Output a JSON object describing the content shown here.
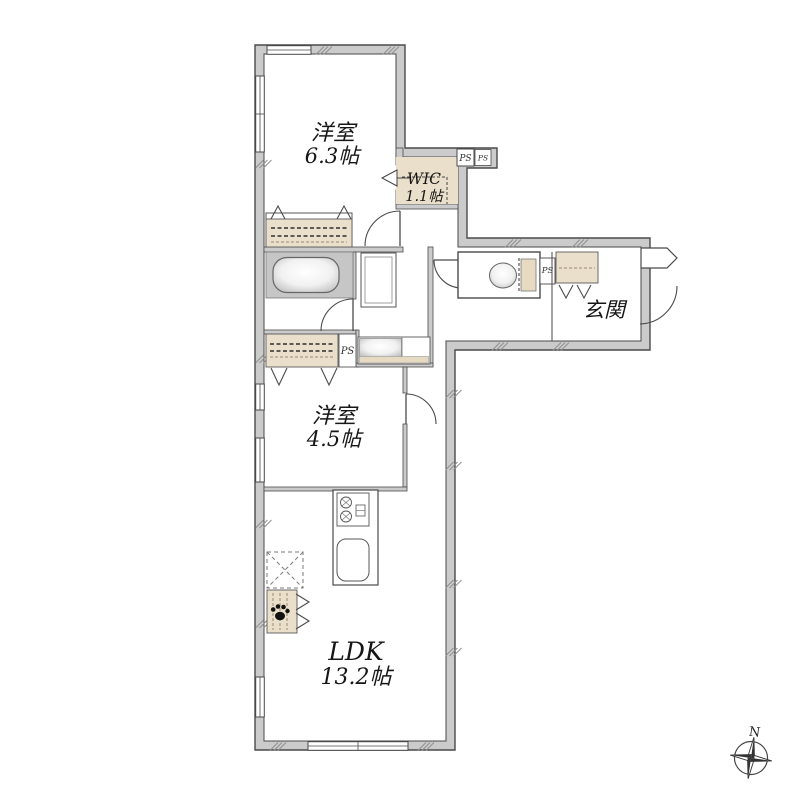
{
  "document": {
    "type": "apartment-floor-plan"
  },
  "rooms": {
    "bedroom1": {
      "name": "洋室",
      "size": "6.3帖"
    },
    "wic": {
      "name": "WIC",
      "size": "1.1帖"
    },
    "bedroom2": {
      "name": "洋室",
      "size": "4.5帖"
    },
    "ldk": {
      "name": "LDK",
      "size": "13.2帖"
    },
    "entrance": {
      "name": "玄関"
    }
  },
  "labels": {
    "pipe_space": "PS",
    "compass_north": "N"
  },
  "fixtures": [
    "bathtub",
    "washing-machine-pan",
    "washbasin",
    "toilet",
    "2-burner-stove",
    "kitchen-sink",
    "refrigerator-space",
    "pet-space",
    "shoe-cabinet",
    "closet",
    "walk-in-closet",
    "pipe-space",
    "compass"
  ],
  "colors": {
    "wall_fill": "#cbcbcb",
    "accent_beige": "#eadfca",
    "fixture_gray": "#c6c6c6",
    "line": "#4a4a4a"
  }
}
